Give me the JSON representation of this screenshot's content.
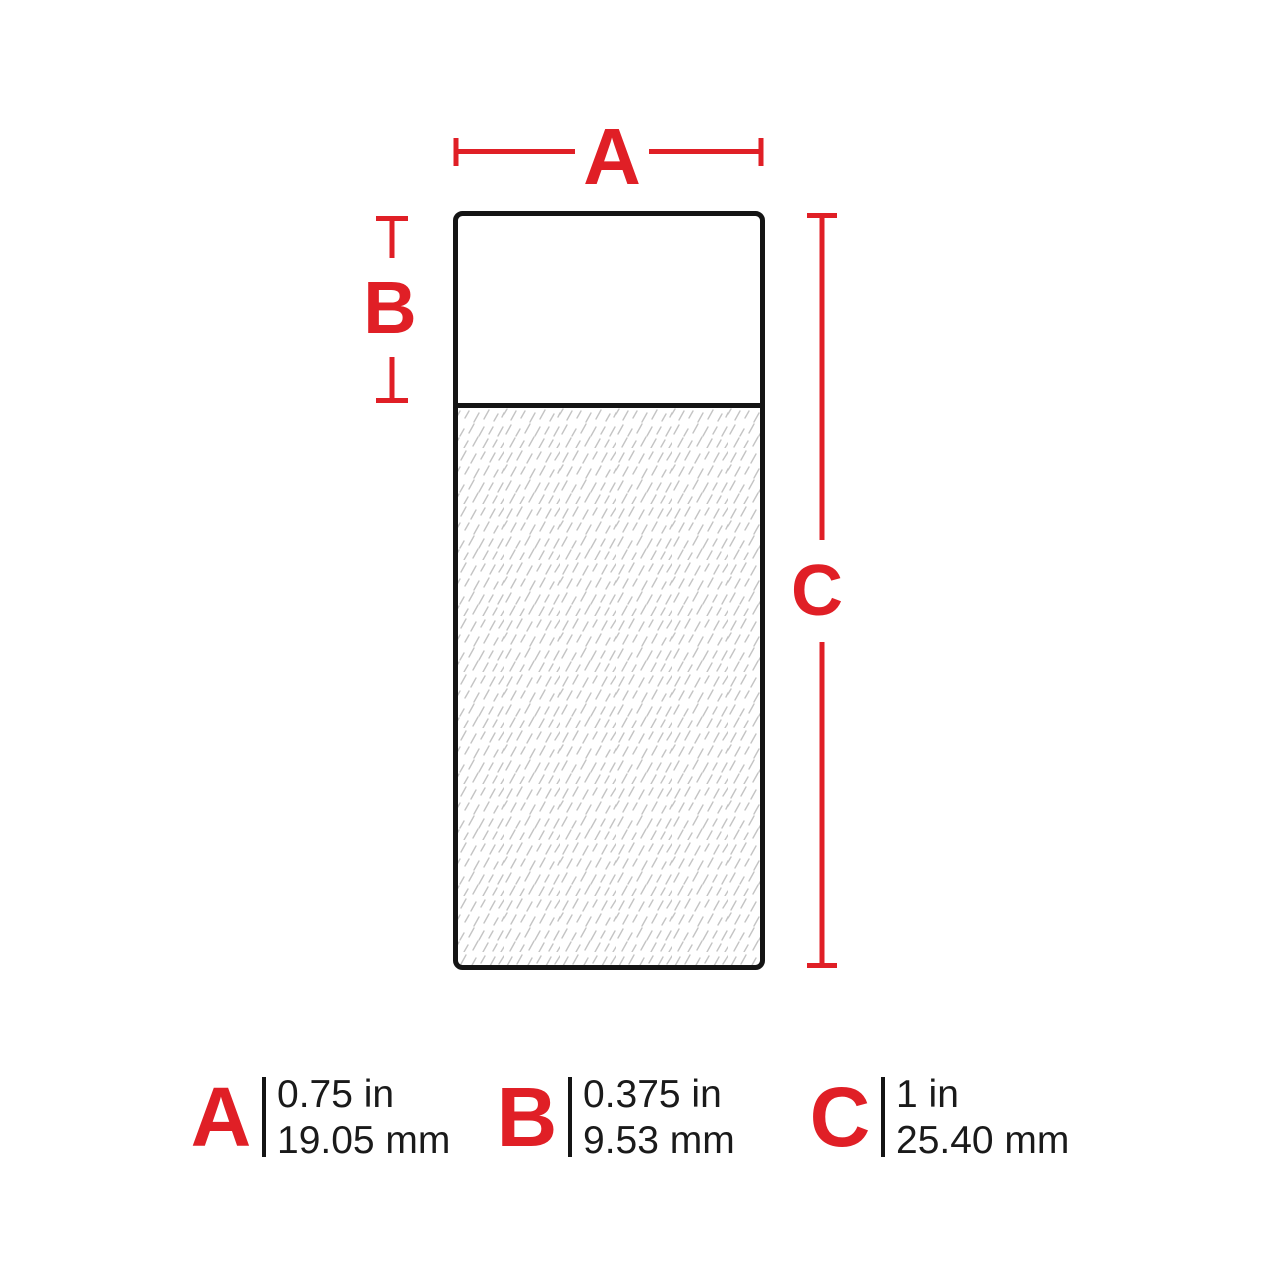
{
  "diagram": {
    "dim_labels": {
      "a": "A",
      "b": "B",
      "c": "C"
    }
  },
  "legend": {
    "entries": [
      {
        "letter": "A",
        "inches": "0.75 in",
        "millimeters": "19.05 mm"
      },
      {
        "letter": "B",
        "inches": "0.375 in",
        "millimeters": "9.53 mm"
      },
      {
        "letter": "C",
        "inches": "1 in",
        "millimeters": "25.40 mm"
      }
    ]
  },
  "colors": {
    "accent_red": "#e01f26",
    "line_black": "#141414",
    "hatch_gray": "#c4c4c4",
    "text_black": "#1a1a1a"
  }
}
